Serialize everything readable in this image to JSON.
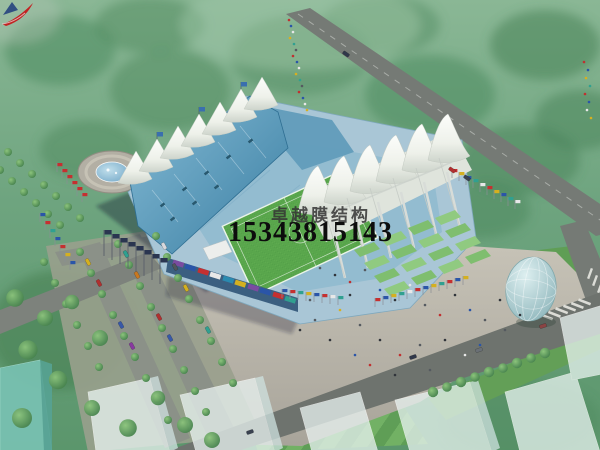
{
  "image": {
    "type": "architectural aerial rendering",
    "subject": "tensile membrane-roof stadium complex with football pitch, circular fountain plaza, tree-lined parking, roads, glass dome pavilion and translucent city blocks",
    "view": "oblique aerial, hazy green landscape"
  },
  "watermark": {
    "company": "卓越膜结构",
    "phone": "15343815143",
    "logo": "red-swoosh-with-blue-sail"
  },
  "palette": {
    "canopy_white": "#f2f5ef",
    "roof_blue": "#4f93b6",
    "seating_blue": "#9cc2d5",
    "pitch_green": "#55a14a",
    "terrace_green": "#7fbe6f",
    "landscape_green": "#6da37e",
    "plaza_gray": "#bcb8ac",
    "road_gray": "#757a75",
    "glass_dome": "#aacdd0",
    "accent_red": "#c22222",
    "company_text": "#3c3c3c",
    "phone_text": "#0d0d0d"
  }
}
